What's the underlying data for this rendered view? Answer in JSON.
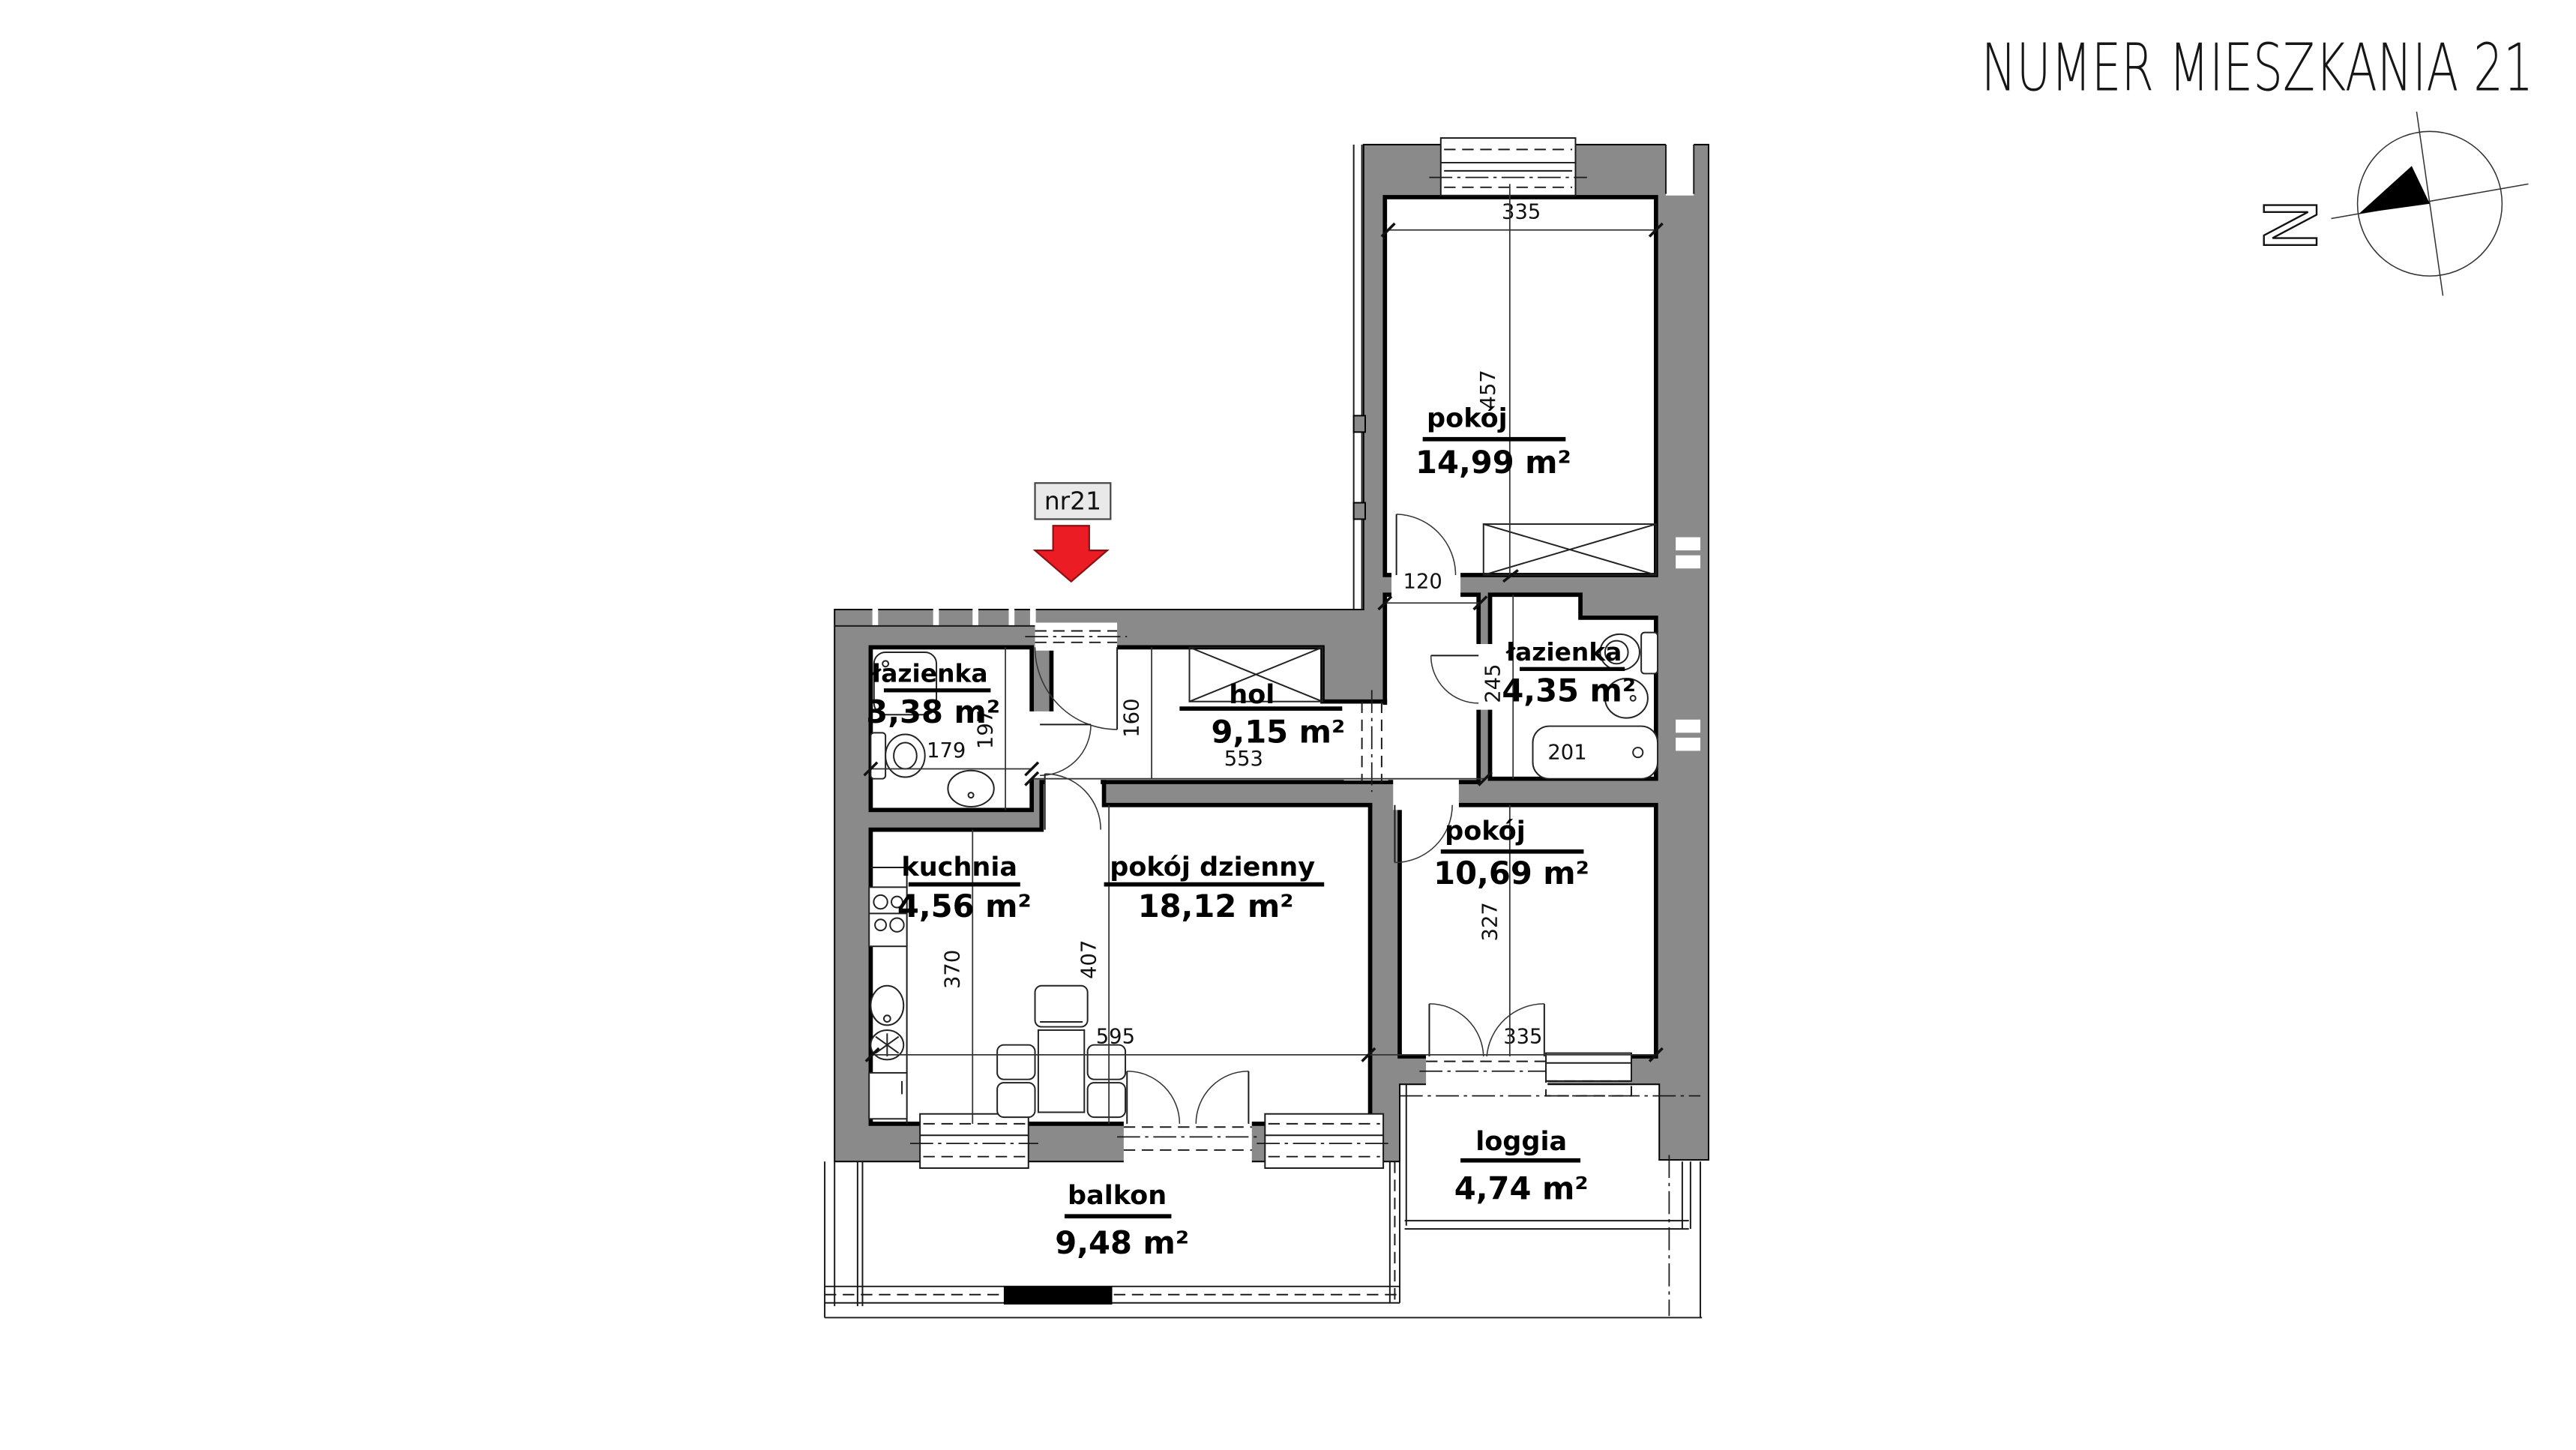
{
  "header": {
    "title": "NUMER MIESZKANIA 21"
  },
  "unit_marker": {
    "label": "nr21"
  },
  "compass": {
    "north_letter": "N"
  },
  "rooms": {
    "pokoj1": {
      "name": "pokój",
      "area": "14,99 m²",
      "dim_w": "335",
      "dim_h": "457"
    },
    "lazienka2": {
      "name": "łazienka",
      "area": "4,35 m²",
      "dim_h": "245",
      "dim_tub": "201",
      "dim_pass": "120"
    },
    "pokoj2": {
      "name": "pokój",
      "area": "10,69 m²",
      "dim_h": "327",
      "dim_w": "335"
    },
    "hol": {
      "name": "hol",
      "area": "9,15 m²",
      "dim_h": "160",
      "dim_w": "553"
    },
    "lazienka1": {
      "name": "łazienka",
      "area": "3,38 m²",
      "dim_w": "179",
      "dim_h": "197"
    },
    "kuchnia": {
      "name": "kuchnia",
      "area": "4,56 m²",
      "dim_h": "370",
      "dim_w": "595"
    },
    "dzienny": {
      "name": "pokój dzienny",
      "area": "18,12 m²",
      "dim_h": "407"
    },
    "balkon": {
      "name": "balkon",
      "area": "9,48 m²"
    },
    "loggia": {
      "name": "loggia",
      "area": "4,74 m²"
    }
  },
  "colors": {
    "wall": "#8a8a8a",
    "arrow_red": "#ec1c24",
    "label_box": "#e9e9e9"
  }
}
